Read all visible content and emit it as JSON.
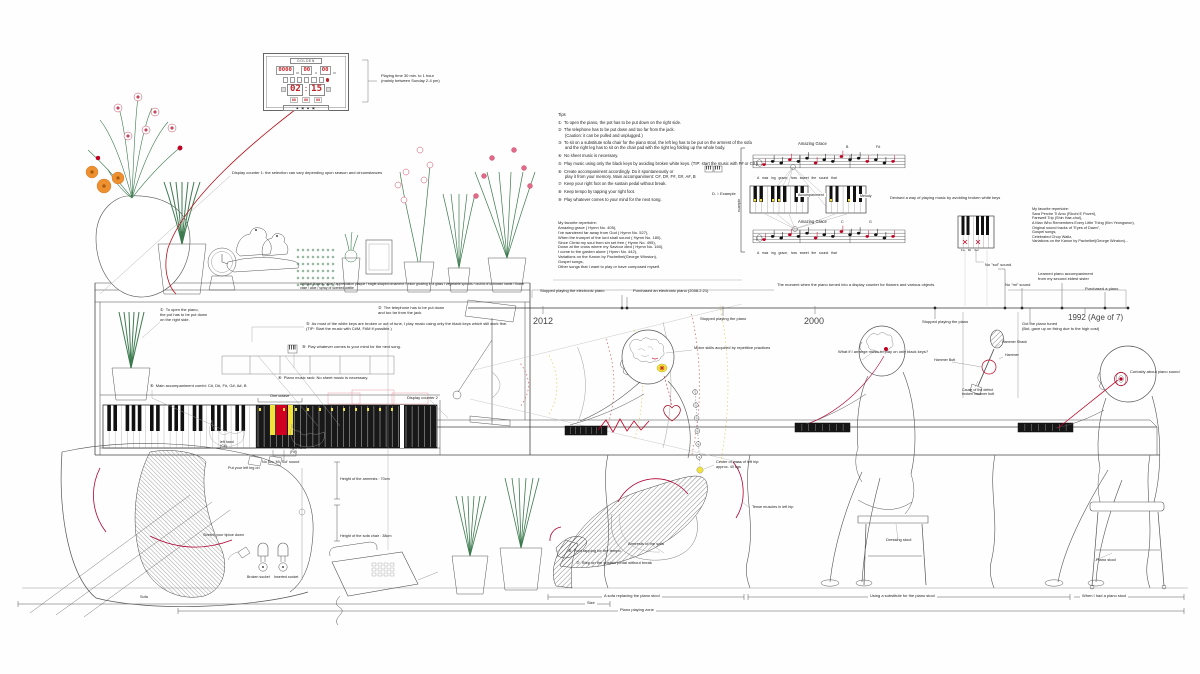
{
  "colors": {
    "accent_red": "#c00023",
    "highlight_yellow": "#f2e23b",
    "plant_green": "#3c7a4e",
    "digit_red": "#c22328"
  },
  "clock": {
    "brand": "GOLDEN",
    "date_digits": [
      "0000",
      "00",
      "00"
    ],
    "time": [
      "02",
      "15"
    ],
    "small_digits": [
      "00",
      "00",
      "00"
    ],
    "strip": "◆ ▣ ◆ ▣",
    "caption": [
      "Playing time 30 min. to 1 hour",
      "(mainly between Sunday 2-4 pm)"
    ]
  },
  "annotations": [
    {
      "id": "playing-time",
      "x": 381,
      "y": 74,
      "fs": 4,
      "lines": [
        "Playing time 30 min. to 1 hour",
        "(mainly between Sunday 2-4 pm)"
      ]
    },
    {
      "id": "display-counter-1",
      "x": 232,
      "y": 171,
      "fs": 4,
      "t": "Display counter 1: the selection can vary depending upon season and circumstances"
    },
    {
      "id": "shelf-items",
      "x": 300,
      "y": 282,
      "fs": 3.4,
      "w": 232,
      "t": "Artificial flowers / aloe / appreciation plaque / eagle-shaped ornament / onion growing in a glass / vegetable sprouts / orchid of unknown name / flower vase / aloe / spray of scented wattle"
    },
    {
      "id": "tips",
      "x": 558,
      "y": 112,
      "fs": 4.2,
      "lines": [
        "Tips",
        "",
        "①  To open the piano, the pot has to be put down on the right side.",
        "",
        "②  The telephone has to be put down and too far from the jack.",
        "      (Caution: it can be pulled and unplugged.)",
        "",
        "③  To sit on a substitute sofa chair for the piano stool, the left leg has to be put on the armrest of the sofa",
        "      and the right leg has to sit on the chair pad with the right leg folding up the whole body.",
        "",
        "④  No sheet music is necessary.",
        "",
        "⑤  Play music using only the black keys by avoiding broken white keys. (TIP: start the music with F# or C#.)",
        "",
        "⑥  Create accompaniment accordingly. Do it spontaneously or",
        "      play it from your memory. Main accompaniment: C#, D#, F#, G#, A#, B",
        "",
        "⑦  Keep your right foot on the sustain pedal without break.",
        "",
        "⑧  Keep tempo by tapping your right foot.",
        "",
        "⑨  Play whatever comes to your mind for the next song."
      ]
    },
    {
      "id": "repertoire-left",
      "x": 558,
      "y": 221,
      "fs": 4,
      "lines": [
        "My favorite repertoire:",
        "Amazing grace ( Hymn No. 405),",
        "I've wandered far away from God ( Hymn No. 527),",
        "When the trumpet of the lord shall sound ( Hymn No. 180),",
        "Since Christ my soul from sin set free ( Hymn No. 495),",
        "Down at the cross where my Saviour died ( Hymn No. 160),",
        "I come to the garden alone ( Hymn No. 442),",
        "Variations on the Kanon by Pachelbel(George Winston),",
        "Gospel songs,",
        "Other songs that I want to play or have composed myself."
      ]
    },
    {
      "id": "repertoire-right",
      "x": 1032,
      "y": 207,
      "fs": 3.8,
      "lines": [
        "My favorite repertoire:",
        "Sara Perche Ti Amo (Ricchi E Poveri),",
        "Farewell Trip (Shin Hae-chul),",
        "A Man Who Remembers Every Little Thing (Kim Yeongseon),",
        "Original sound tracks of \"Eyes of Dawn\",",
        "Gospel songs,",
        "Celebrated Chop Waltz,",
        "Variations on the Kanon by Pachelbel(George Winston)..."
      ]
    },
    {
      "id": "amazing-grace-top",
      "x": 798,
      "y": 141,
      "fs": 4.2,
      "t": "Amazing Grace"
    },
    {
      "id": "amazing-grace-bottom",
      "x": 798,
      "y": 219,
      "fs": 4.2,
      "t": "Amazing Grace"
    },
    {
      "id": "chord-top-1",
      "x": 846,
      "y": 145,
      "fs": 3.6,
      "t": "B"
    },
    {
      "id": "chord-top-2",
      "x": 876,
      "y": 145,
      "fs": 3.6,
      "t": "F#"
    },
    {
      "id": "chord-bottom-1",
      "x": 841,
      "y": 220,
      "fs": 3.6,
      "t": "C"
    },
    {
      "id": "chord-bottom-2",
      "x": 869,
      "y": 220,
      "fs": 3.6,
      "t": "G"
    },
    {
      "id": "lyrics-top",
      "x": 757,
      "y": 176,
      "fs": 3.4,
      "t": "A   maz   ing   grace,   how   sweet   the   sound   that"
    },
    {
      "id": "lyrics-bottom",
      "x": 757,
      "y": 251,
      "fs": 3.4,
      "t": "A   maz   ing   grace,   how   sweet   the   sound   that"
    },
    {
      "id": "accompaniment-kbd",
      "x": 796,
      "y": 193,
      "fs": 3.6,
      "bg": 1,
      "t": "Accompaniment"
    },
    {
      "id": "melody-kbd",
      "x": 858,
      "y": 194,
      "fs": 3.6,
      "bg": 1,
      "t": "Melody"
    },
    {
      "id": "d-example",
      "x": 712,
      "y": 192,
      "fs": 4,
      "t": "D. ♭ Example"
    },
    {
      "id": "example-vert",
      "x": 737,
      "y": 212,
      "fs": 3.5,
      "rot": -90,
      "t": "example"
    },
    {
      "id": "devised",
      "x": 890,
      "y": 196,
      "fs": 4,
      "t": "Devised a way of playing music by avoiding broken white keys"
    },
    {
      "id": "fa-mi-sol",
      "x": 961,
      "y": 249,
      "fs": 3,
      "t": "Fa    Mi    Sol"
    },
    {
      "id": "no-sol-sound",
      "x": 985,
      "y": 263,
      "fs": 4,
      "t": "No \"sol\" sound"
    },
    {
      "id": "no-mi-sound",
      "x": 1005,
      "y": 283,
      "fs": 4,
      "t": "No \"mi\" sound"
    },
    {
      "id": "moment-display",
      "x": 777,
      "y": 283,
      "fs": 4,
      "t": "The moment when the piano turned into a display counter for flowers and various objects"
    },
    {
      "id": "stopped-electronic",
      "x": 540,
      "y": 289,
      "fs": 4,
      "t": "Stopped playing the electronic piano"
    },
    {
      "id": "purchased-electronic",
      "x": 633,
      "y": 289,
      "fs": 4,
      "t": "Purchased an electronic piano (2008.2.21)"
    },
    {
      "id": "stopped-piano-1",
      "x": 700,
      "y": 317,
      "fs": 4,
      "t": "Stopped playing the piano"
    },
    {
      "id": "stopped-piano-2",
      "x": 922,
      "y": 320,
      "fs": 4,
      "t": "Stopped playing the piano"
    },
    {
      "id": "learned-accomp",
      "x": 1038,
      "y": 272,
      "fs": 4,
      "lines": [
        "Learned piano accompaniment",
        "from my second eldest sister"
      ]
    },
    {
      "id": "purchased-piano",
      "x": 1085,
      "y": 287,
      "fs": 4,
      "t": "Purchased a piano"
    },
    {
      "id": "got-tuned",
      "x": 1022,
      "y": 322,
      "fs": 4,
      "lines": [
        "Got the piano tuned",
        "(But, gave up on fixing due to the high cost)"
      ]
    },
    {
      "id": "year-2012",
      "x": 533,
      "y": 316,
      "fs": 9,
      "color": "#444",
      "t": "2012"
    },
    {
      "id": "year-2000",
      "x": 804,
      "y": 316,
      "fs": 9,
      "color": "#444",
      "t": "2000"
    },
    {
      "id": "year-1992",
      "x": 1068,
      "y": 313,
      "fs": 8,
      "color": "#444",
      "t": "1992 (Age of 7)"
    },
    {
      "id": "hammer-shank",
      "x": 1002,
      "y": 340,
      "fs": 3.6,
      "t": "Hammer Shank"
    },
    {
      "id": "hammer",
      "x": 1005,
      "y": 353,
      "fs": 3.6,
      "t": "Hammer"
    },
    {
      "id": "hammer-butt",
      "x": 934,
      "y": 358,
      "fs": 3.6,
      "t": "Hammer Butt"
    },
    {
      "id": "cause-defect",
      "x": 962,
      "y": 388,
      "fs": 3.6,
      "lines": [
        "Cause of the defect",
        "broken hammer butt"
      ]
    },
    {
      "id": "curiosity",
      "x": 1130,
      "y": 370,
      "fs": 4,
      "w": 58,
      "t": "Curiosity about piano sound"
    },
    {
      "id": "motor-skills",
      "x": 694,
      "y": 346,
      "fs": 4,
      "t": "Motor skills acquired by repetitive practices"
    },
    {
      "id": "what-if",
      "x": 838,
      "y": 350,
      "fs": 4,
      "w": 92,
      "t": "What if I arrange music to play on only black keys?"
    },
    {
      "id": "tip1-note",
      "x": 160,
      "y": 308,
      "fs": 4,
      "lines": [
        "①  To open the piano,",
        "the pot has to be put down",
        "on the right side."
      ]
    },
    {
      "id": "tip5-note",
      "x": 306,
      "y": 322,
      "fs": 4,
      "w": 226,
      "lines": [
        "⑤  As most of the white keys are broken or out of tune, I play music using only the black keys which still work fine.",
        "(TIP: Start the music with C#M, F#M if possible.)"
      ]
    },
    {
      "id": "tip2-note",
      "x": 378,
      "y": 306,
      "fs": 4,
      "w": 98,
      "lines": [
        "②  The telephone has to be put down",
        "and too far from the jack."
      ]
    },
    {
      "id": "tip9-note",
      "x": 302,
      "y": 345,
      "fs": 4,
      "t": "⑨  Play whatever comes to your mind for the next song."
    },
    {
      "id": "tip4-note",
      "x": 278,
      "y": 376,
      "fs": 4,
      "t": "④  Piano music rack: No sheet music is necessary."
    },
    {
      "id": "tip6-note",
      "x": 150,
      "y": 384,
      "fs": 4,
      "t": "⑥  Main accompaniment combi: C#, D#, F#, G#, A#, B"
    },
    {
      "id": "one-octave",
      "x": 270,
      "y": 394,
      "fs": 3.8,
      "t": "One octave"
    },
    {
      "id": "display-counter-2",
      "x": 407,
      "y": 396,
      "fs": 4,
      "t": "Display counter 2"
    },
    {
      "id": "left-hand",
      "x": 220,
      "y": 440,
      "fs": 3.6,
      "lines": [
        "left hand",
        "(C#)"
      ]
    },
    {
      "id": "right-hand",
      "x": 290,
      "y": 446,
      "fs": 3.6,
      "lines": [
        "right hand",
        "(F#)"
      ]
    },
    {
      "id": "no-do-mi-sol",
      "x": 262,
      "y": 460,
      "fs": 3.8,
      "t": "No 'Do, Mi, Sol' sound"
    },
    {
      "id": "put-left-leg",
      "x": 228,
      "y": 466,
      "fs": 3.8,
      "t": "Put your left leg on"
    },
    {
      "id": "tiptoe",
      "x": 203,
      "y": 533,
      "fs": 3.8,
      "t": "Stretch your tiptoe down"
    },
    {
      "id": "armrest-height",
      "x": 340,
      "y": 477,
      "fs": 3.8,
      "t": "Height of the armrests : 70cm"
    },
    {
      "id": "sofa-height",
      "x": 340,
      "y": 534,
      "fs": 3.8,
      "t": "Height of the sofa chair : 38cm"
    },
    {
      "id": "broken-socket",
      "x": 247,
      "y": 575,
      "fs": 3.6,
      "t": "Broken socket"
    },
    {
      "id": "inserted-socket",
      "x": 274,
      "y": 575,
      "fs": 3.6,
      "t": "Inserted socket"
    },
    {
      "id": "sofa-corner",
      "x": 140,
      "y": 595,
      "fs": 3.8,
      "t": "Sofa"
    },
    {
      "id": "foot-tapping",
      "x": 568,
      "y": 549,
      "fs": 4,
      "t": "⑧  Foot tapping for the tempo"
    },
    {
      "id": "sustain-step",
      "x": 576,
      "y": 561,
      "fs": 4,
      "t": "⑦  Step on the sustain pedal without break"
    },
    {
      "id": "armrests-sofa",
      "x": 628,
      "y": 542,
      "fs": 4,
      "t": "Armrests of the sofa"
    },
    {
      "id": "center-mass",
      "x": 716,
      "y": 460,
      "fs": 3.8,
      "lines": [
        "Center of mass of left hip:",
        "approx. 40 kgs"
      ]
    },
    {
      "id": "tense-muscles",
      "x": 752,
      "y": 505,
      "fs": 3.8,
      "t": "Tense muscles in left hip"
    },
    {
      "id": "dressing-stool",
      "x": 886,
      "y": 538,
      "fs": 4,
      "t": "Dressing stool"
    },
    {
      "id": "piano-stool",
      "x": 1096,
      "y": 558,
      "fs": 4,
      "t": "Piano stool"
    },
    {
      "id": "sofa-replacing",
      "x": 602,
      "y": 594,
      "fs": 4,
      "bg": 1,
      "t": "A sofa replacing the piano stool"
    },
    {
      "id": "substitute-stool",
      "x": 868,
      "y": 594,
      "fs": 4,
      "bg": 1,
      "t": "Using a substitute for the piano stool"
    },
    {
      "id": "when-piano-stool",
      "x": 1080,
      "y": 594,
      "fs": 4,
      "bg": 1,
      "t": "When I had a piano stool"
    },
    {
      "id": "size-label",
      "x": 585,
      "y": 601,
      "fs": 4,
      "bg": 1,
      "t": "Size"
    },
    {
      "id": "piano-playing-zone",
      "x": 618,
      "y": 608,
      "fs": 4,
      "bg": 1,
      "t": "Piano playing zone"
    }
  ]
}
